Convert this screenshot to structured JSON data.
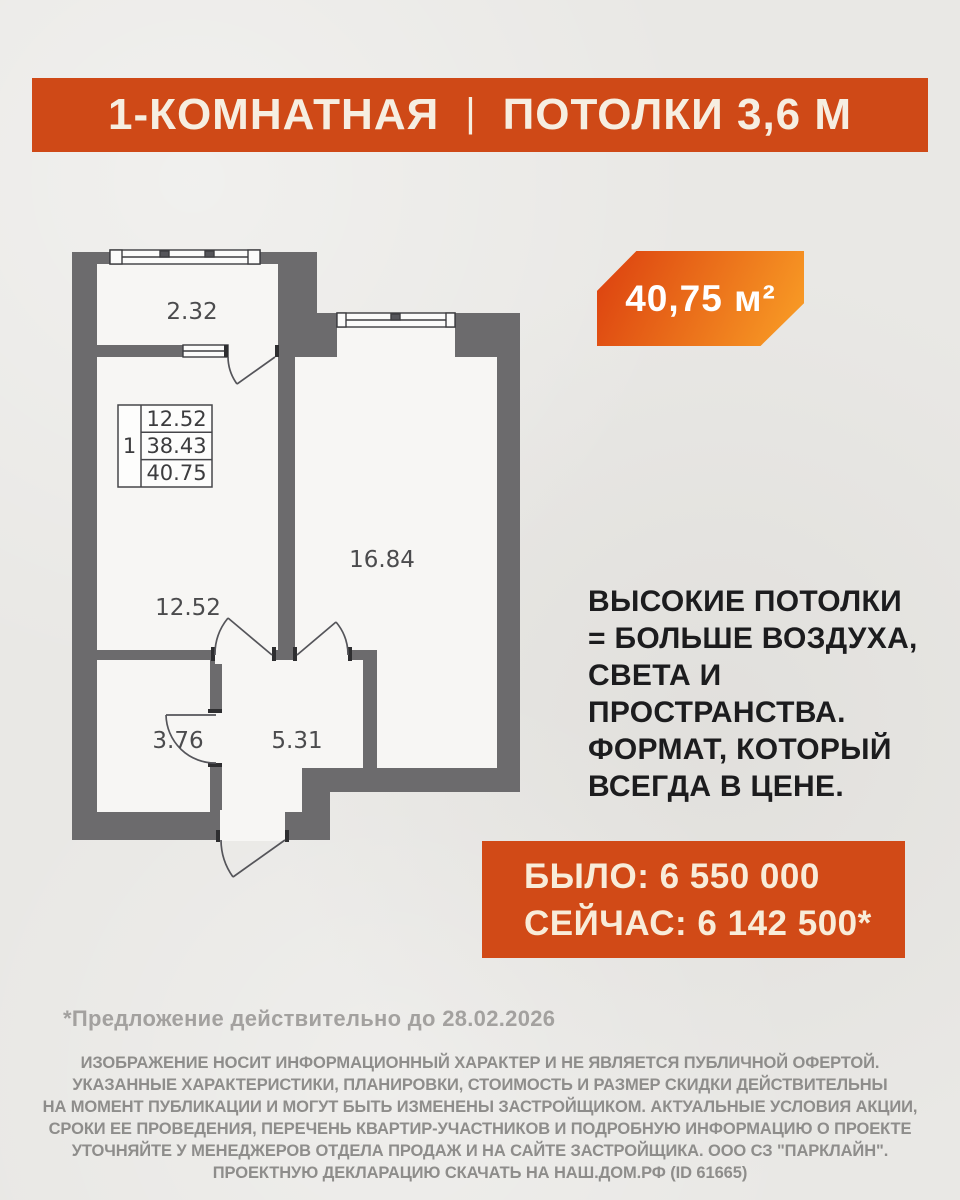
{
  "header": {
    "room_type": "1-КОМНАТНАЯ",
    "divider": "|",
    "ceilings": "ПОТОЛКИ 3,6 М"
  },
  "area_badge": {
    "value": "40,75 м²"
  },
  "floor_plan": {
    "labels": {
      "balcony": "2.32",
      "room_main": "12.52",
      "room_living": "16.84",
      "bathroom": "3.76",
      "hall": "5.31"
    },
    "table": {
      "unit": "1",
      "rows": [
        "12.52",
        "38.43",
        "40.75"
      ]
    }
  },
  "headline": {
    "text": "ВЫСОКИЕ ПОТОЛКИ\n= БОЛЬШЕ ВОЗДУХА,\nСВЕТА И\nПРОСТРАНСТВА.\nФОРМАТ, КОТОРЫЙ\nВСЕГДА В ЦЕНЕ."
  },
  "price": {
    "was": "БЫЛО: 6 550 000",
    "now": "СЕЙЧАС: 6 142 500*"
  },
  "footnote": {
    "text": "*Предложение действительно до 28.02.2026"
  },
  "disclaimer": {
    "text": "ИЗОБРАЖЕНИЕ НОСИТ ИНФОРМАЦИОННЫЙ ХАРАКТЕР И НЕ ЯВЛЯЕТСЯ ПУБЛИЧНОЙ ОФЕРТОЙ.\nУКАЗАННЫЕ ХАРАКТЕРИСТИКИ, ПЛАНИРОВКИ, СТОИМОСТЬ И РАЗМЕР СКИДКИ ДЕЙСТВИТЕЛЬНЫ\nНА МОМЕНТ ПУБЛИКАЦИИ И МОГУТ БЫТЬ ИЗМЕНЕНЫ ЗАСТРОЙЩИКОМ. АКТУАЛЬНЫЕ УСЛОВИЯ АКЦИИ,\nСРОКИ ЕЕ ПРОВЕДЕНИЯ, ПЕРЕЧЕНЬ КВАРТИР-УЧАСТНИКОВ И ПОДРОБНУЮ ИНФОРМАЦИЮ О ПРОЕКТЕ\nУТОЧНЯЙТЕ У МЕНЕДЖЕРОВ ОТДЕЛА ПРОДАЖ И НА САЙТЕ ЗАСТРОЙЩИКА. ООО СЗ \"ПАРКЛАЙН\".\nПРОЕКТНУЮ ДЕКЛАРАЦИЮ СКАЧАТЬ НА НАШ.ДОМ.РФ (ID 61665)"
  },
  "colors": {
    "background": "#e9e8e5",
    "accent_orange": "#cf4917",
    "badge_gradient_start": "#dd4410",
    "badge_gradient_end": "#f89b25",
    "wall_gray": "#6c6b6d",
    "headline_text": "#1c1c1e",
    "cream_text": "#f8ecd9",
    "muted_gray_text": "#8e8d8b"
  }
}
